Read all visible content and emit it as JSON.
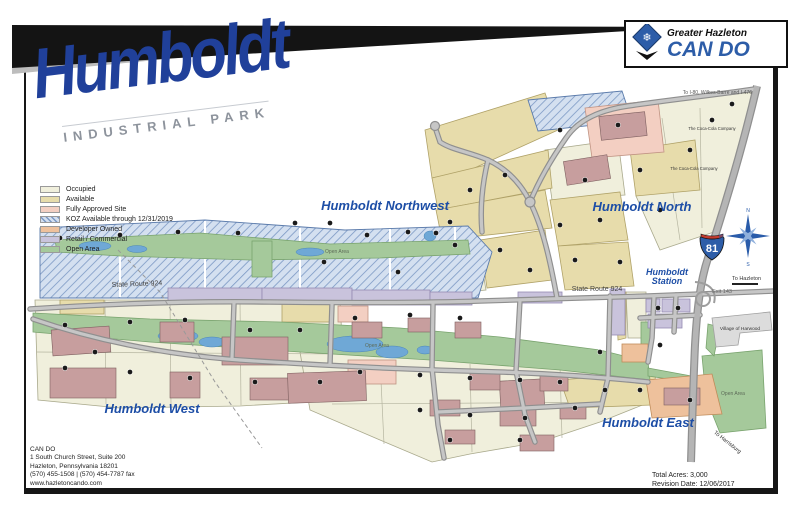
{
  "banner": {
    "title": "Humboldt",
    "subtitle": "INDUSTRIAL PARK"
  },
  "logo": {
    "tagline": "Greater Hazleton",
    "brand": "CAN DO"
  },
  "colors": {
    "brand_blue": "#2d5da8",
    "region_label_blue": "#1d4ea6",
    "title_blue": "#20409a"
  },
  "legend": {
    "items": [
      {
        "label": "Occupied",
        "color": "#f0efdc",
        "hatch": false
      },
      {
        "label": "Available",
        "color": "#e7dcab",
        "hatch": false
      },
      {
        "label": "Fully Approved Site",
        "color": "#f3cfc2",
        "hatch": false
      },
      {
        "label": "KOZ Available through 12/31/2019",
        "color": "#d4e0f0",
        "hatch": true
      },
      {
        "label": "Developer Owned",
        "color": "#eec19c",
        "hatch": false
      },
      {
        "label": "Retail / Commercial",
        "color": "#c9c3dc",
        "hatch": false
      },
      {
        "label": "Open Area",
        "color": "#a5c99b",
        "hatch": false
      }
    ]
  },
  "map": {
    "regions": {
      "northwest": "Humboldt Northwest",
      "north": "Humboldt North",
      "west": "Humboldt West",
      "east": "Humboldt East",
      "station": "Humboldt Station"
    },
    "roads": {
      "sr924_west": "State Route 924",
      "sr924_east": "State Route 924",
      "interstate_number": "81",
      "exit_label": "Exit 143",
      "to_hazleton": "To Hazleton",
      "to_harrisburg": "To Harrisburg",
      "to_i80": "To I-80, Wilkes-Barre and I-476"
    },
    "places": {
      "village": "Village of Harwood",
      "open_area_nw": "Open Area",
      "open_area_center": "Open Area",
      "open_area_east": "Open Area",
      "coca_cola_1": "The Coca-Cola Company",
      "coca_cola_2": "The Coca-Cola Company"
    },
    "compass": {
      "n": "N",
      "e": "E",
      "s": "S",
      "w": "W"
    }
  },
  "footer": {
    "org": "CAN DO",
    "address_lines": [
      "1 South Church Street, Suite 200",
      "Hazleton, Pennsylvania 18201",
      "(570) 455-1508 | (570) 454-7787 fax",
      "www.hazletoncando.com"
    ],
    "total_acres": "Total Acres: 3,000",
    "revision_date": "Revision Date: 12/06/2017"
  }
}
